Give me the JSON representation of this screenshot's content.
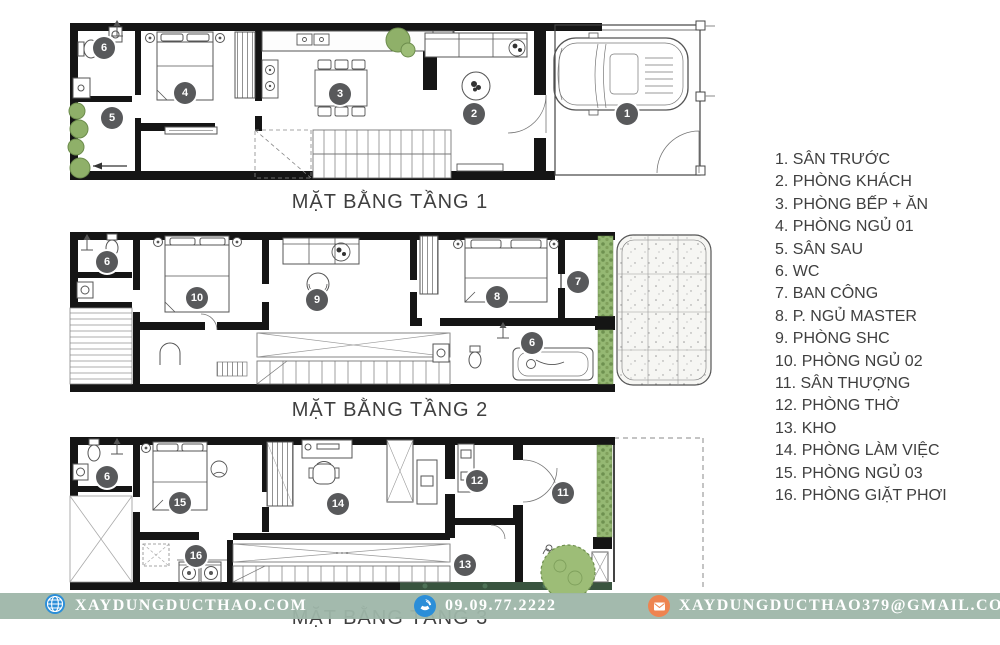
{
  "legend": {
    "items": [
      {
        "num": 1,
        "label": "SÂN TRƯỚC"
      },
      {
        "num": 2,
        "label": "PHÒNG KHÁCH"
      },
      {
        "num": 3,
        "label": "PHÒNG BẾP + ĂN"
      },
      {
        "num": 4,
        "label": "PHÒNG NGỦ 01"
      },
      {
        "num": 5,
        "label": "SÂN SAU"
      },
      {
        "num": 6,
        "label": "WC"
      },
      {
        "num": 7,
        "label": "BAN CÔNG"
      },
      {
        "num": 8,
        "label": "P. NGỦ MASTER"
      },
      {
        "num": 9,
        "label": "PHÒNG SHC"
      },
      {
        "num": 10,
        "label": "PHÒNG NGỦ 02"
      },
      {
        "num": 11,
        "label": "SÂN THƯỢNG"
      },
      {
        "num": 12,
        "label": "PHÒNG THỜ"
      },
      {
        "num": 13,
        "label": "KHO"
      },
      {
        "num": 14,
        "label": "PHÒNG LÀM VIỆC"
      },
      {
        "num": 15,
        "label": "PHÒNG NGỦ 03"
      },
      {
        "num": 16,
        "label": "PHÒNG GIẶT PHƠI"
      }
    ]
  },
  "floors": [
    {
      "id": "floor-1",
      "title": "MẶT BẰNG TẦNG 1",
      "badges": [
        {
          "num": 6,
          "x": 39,
          "y": 40
        },
        {
          "num": 5,
          "x": 47,
          "y": 110
        },
        {
          "num": 4,
          "x": 120,
          "y": 85
        },
        {
          "num": 3,
          "x": 275,
          "y": 86
        },
        {
          "num": 2,
          "x": 409,
          "y": 106
        },
        {
          "num": 1,
          "x": 562,
          "y": 106
        }
      ]
    },
    {
      "id": "floor-2",
      "title": "MẶT BẰNG TẦNG 2",
      "badges": [
        {
          "num": 6,
          "x": 42,
          "y": 36
        },
        {
          "num": 10,
          "x": 132,
          "y": 72
        },
        {
          "num": 9,
          "x": 252,
          "y": 74
        },
        {
          "num": 8,
          "x": 432,
          "y": 71
        },
        {
          "num": 7,
          "x": 513,
          "y": 56
        },
        {
          "num": 6,
          "x": 467,
          "y": 117
        }
      ]
    },
    {
      "id": "floor-3",
      "title": "MẶT BẰNG TẦNG 3",
      "badges": [
        {
          "num": 6,
          "x": 42,
          "y": 45
        },
        {
          "num": 15,
          "x": 115,
          "y": 71
        },
        {
          "num": 16,
          "x": 131,
          "y": 124
        },
        {
          "num": 14,
          "x": 273,
          "y": 72
        },
        {
          "num": 12,
          "x": 412,
          "y": 49
        },
        {
          "num": 13,
          "x": 400,
          "y": 133
        },
        {
          "num": 11,
          "x": 498,
          "y": 61
        }
      ]
    }
  ],
  "footer": {
    "website": "XAYDUNGDUCTHAO.COM",
    "phone": "09.09.77.2222",
    "email": "XAYDUNGDUCTHAO379@GMAIL.COM",
    "band_color": "#9eb6a9",
    "icon_blue": "#2b8ed8",
    "icon_orange": "#ee8450"
  },
  "colors": {
    "badge": "#58595b",
    "wall": "#151515",
    "plant": "#8fb069",
    "title_text": "#3f3f3f"
  }
}
